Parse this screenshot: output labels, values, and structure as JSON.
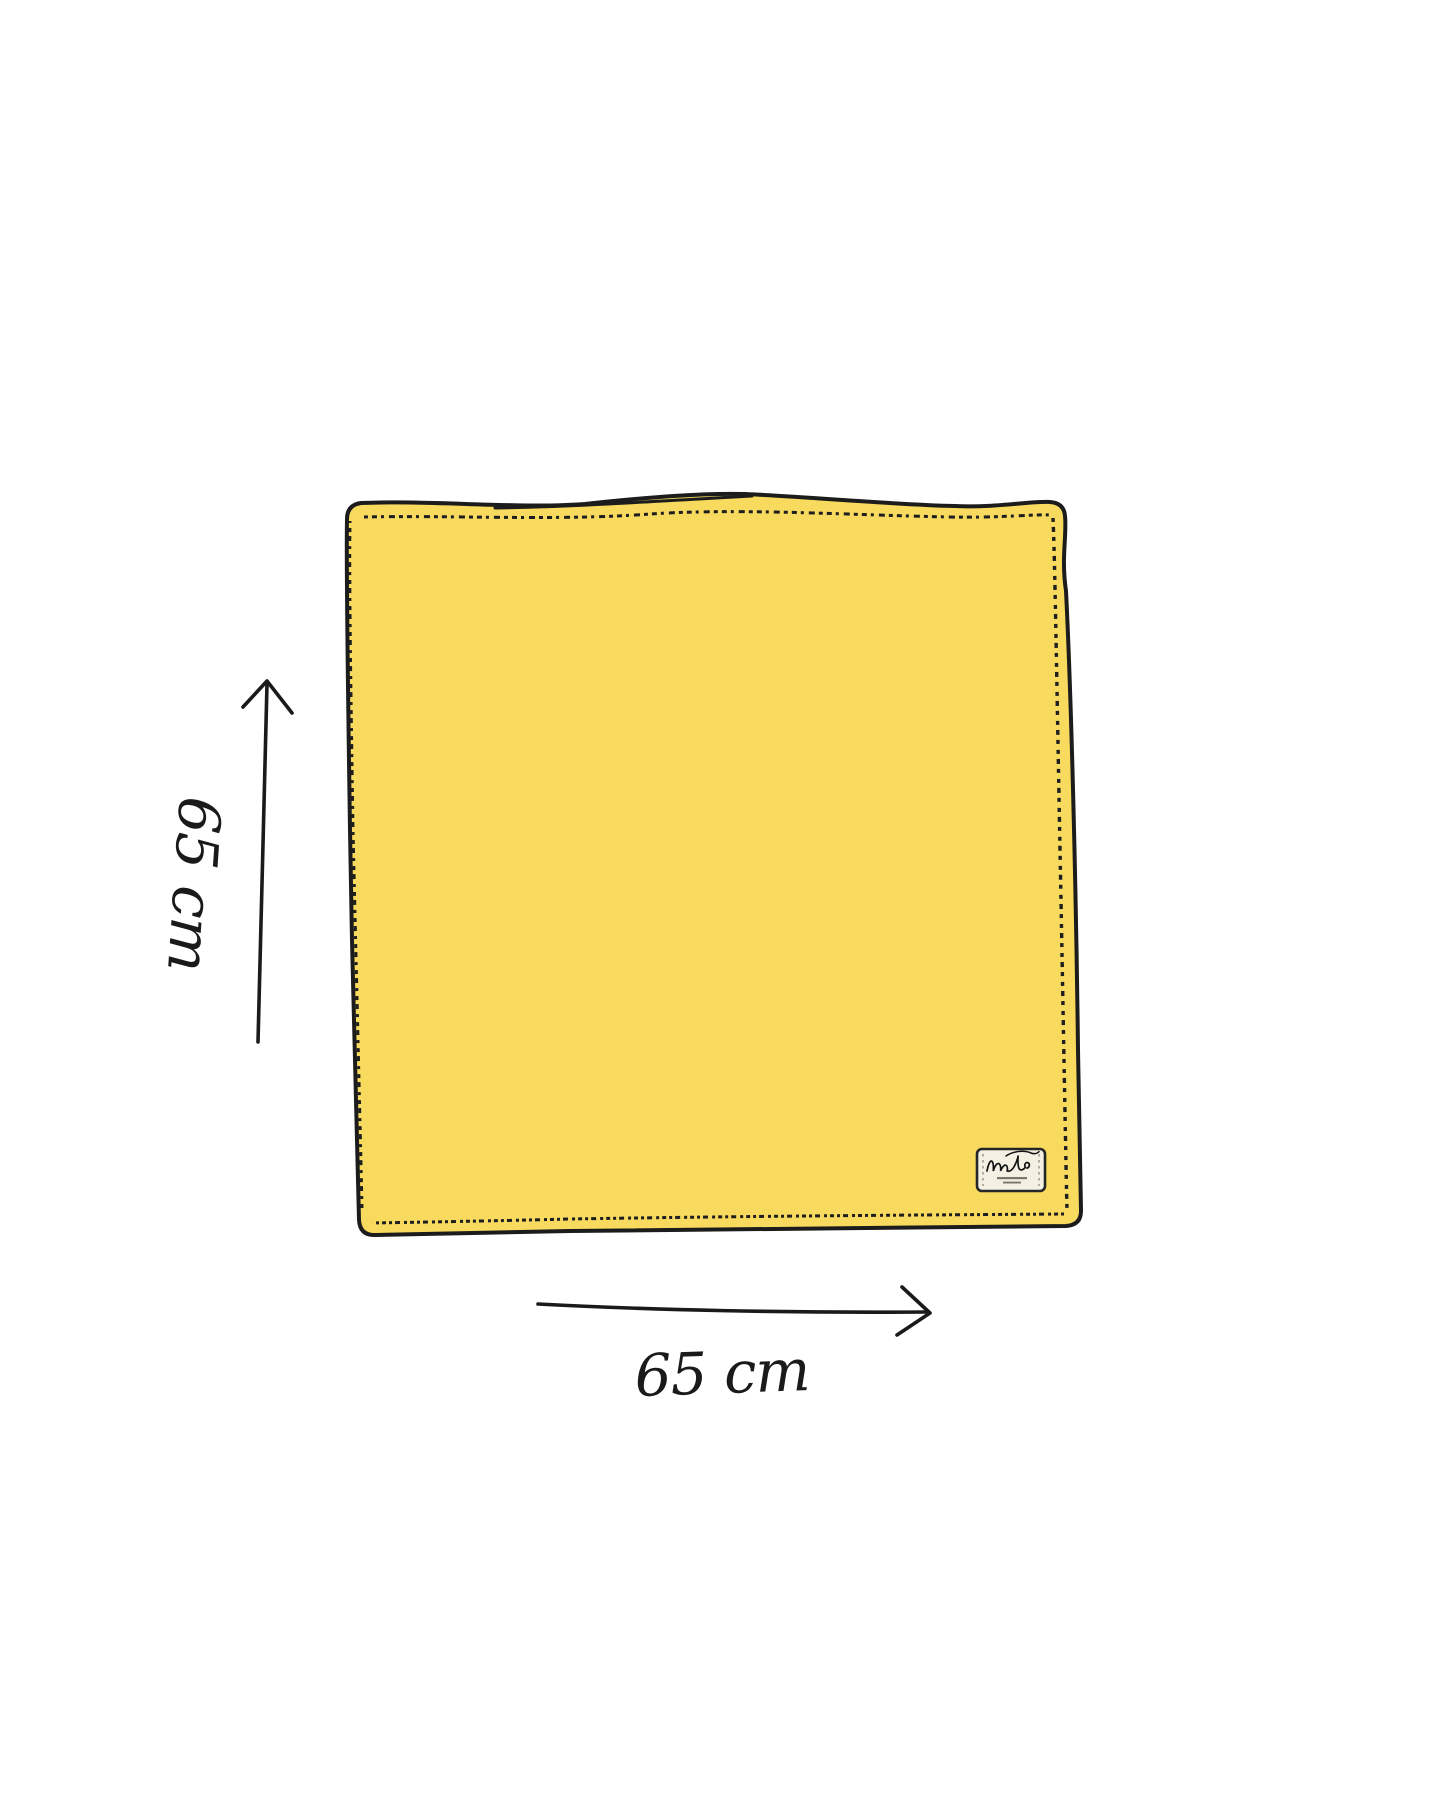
{
  "illustration": {
    "description": "Hand-drawn yellow square cloth with dimension arrows",
    "background_color": "#ffffff",
    "cloth": {
      "fill_color": "#F8DB5E",
      "outline_color": "#1c1c1c",
      "stitch_color": "#1e1e1e"
    },
    "care_label": {
      "background_color": "#F4F0E3",
      "border_color": "#262626",
      "signature_icon": "brand-signature",
      "stitch_color": "#9a9689"
    },
    "height_dimension": {
      "label": "65 cm",
      "arrow_icon": "up-arrow"
    },
    "width_dimension": {
      "label": "65 cm",
      "arrow_icon": "right-arrow"
    }
  }
}
